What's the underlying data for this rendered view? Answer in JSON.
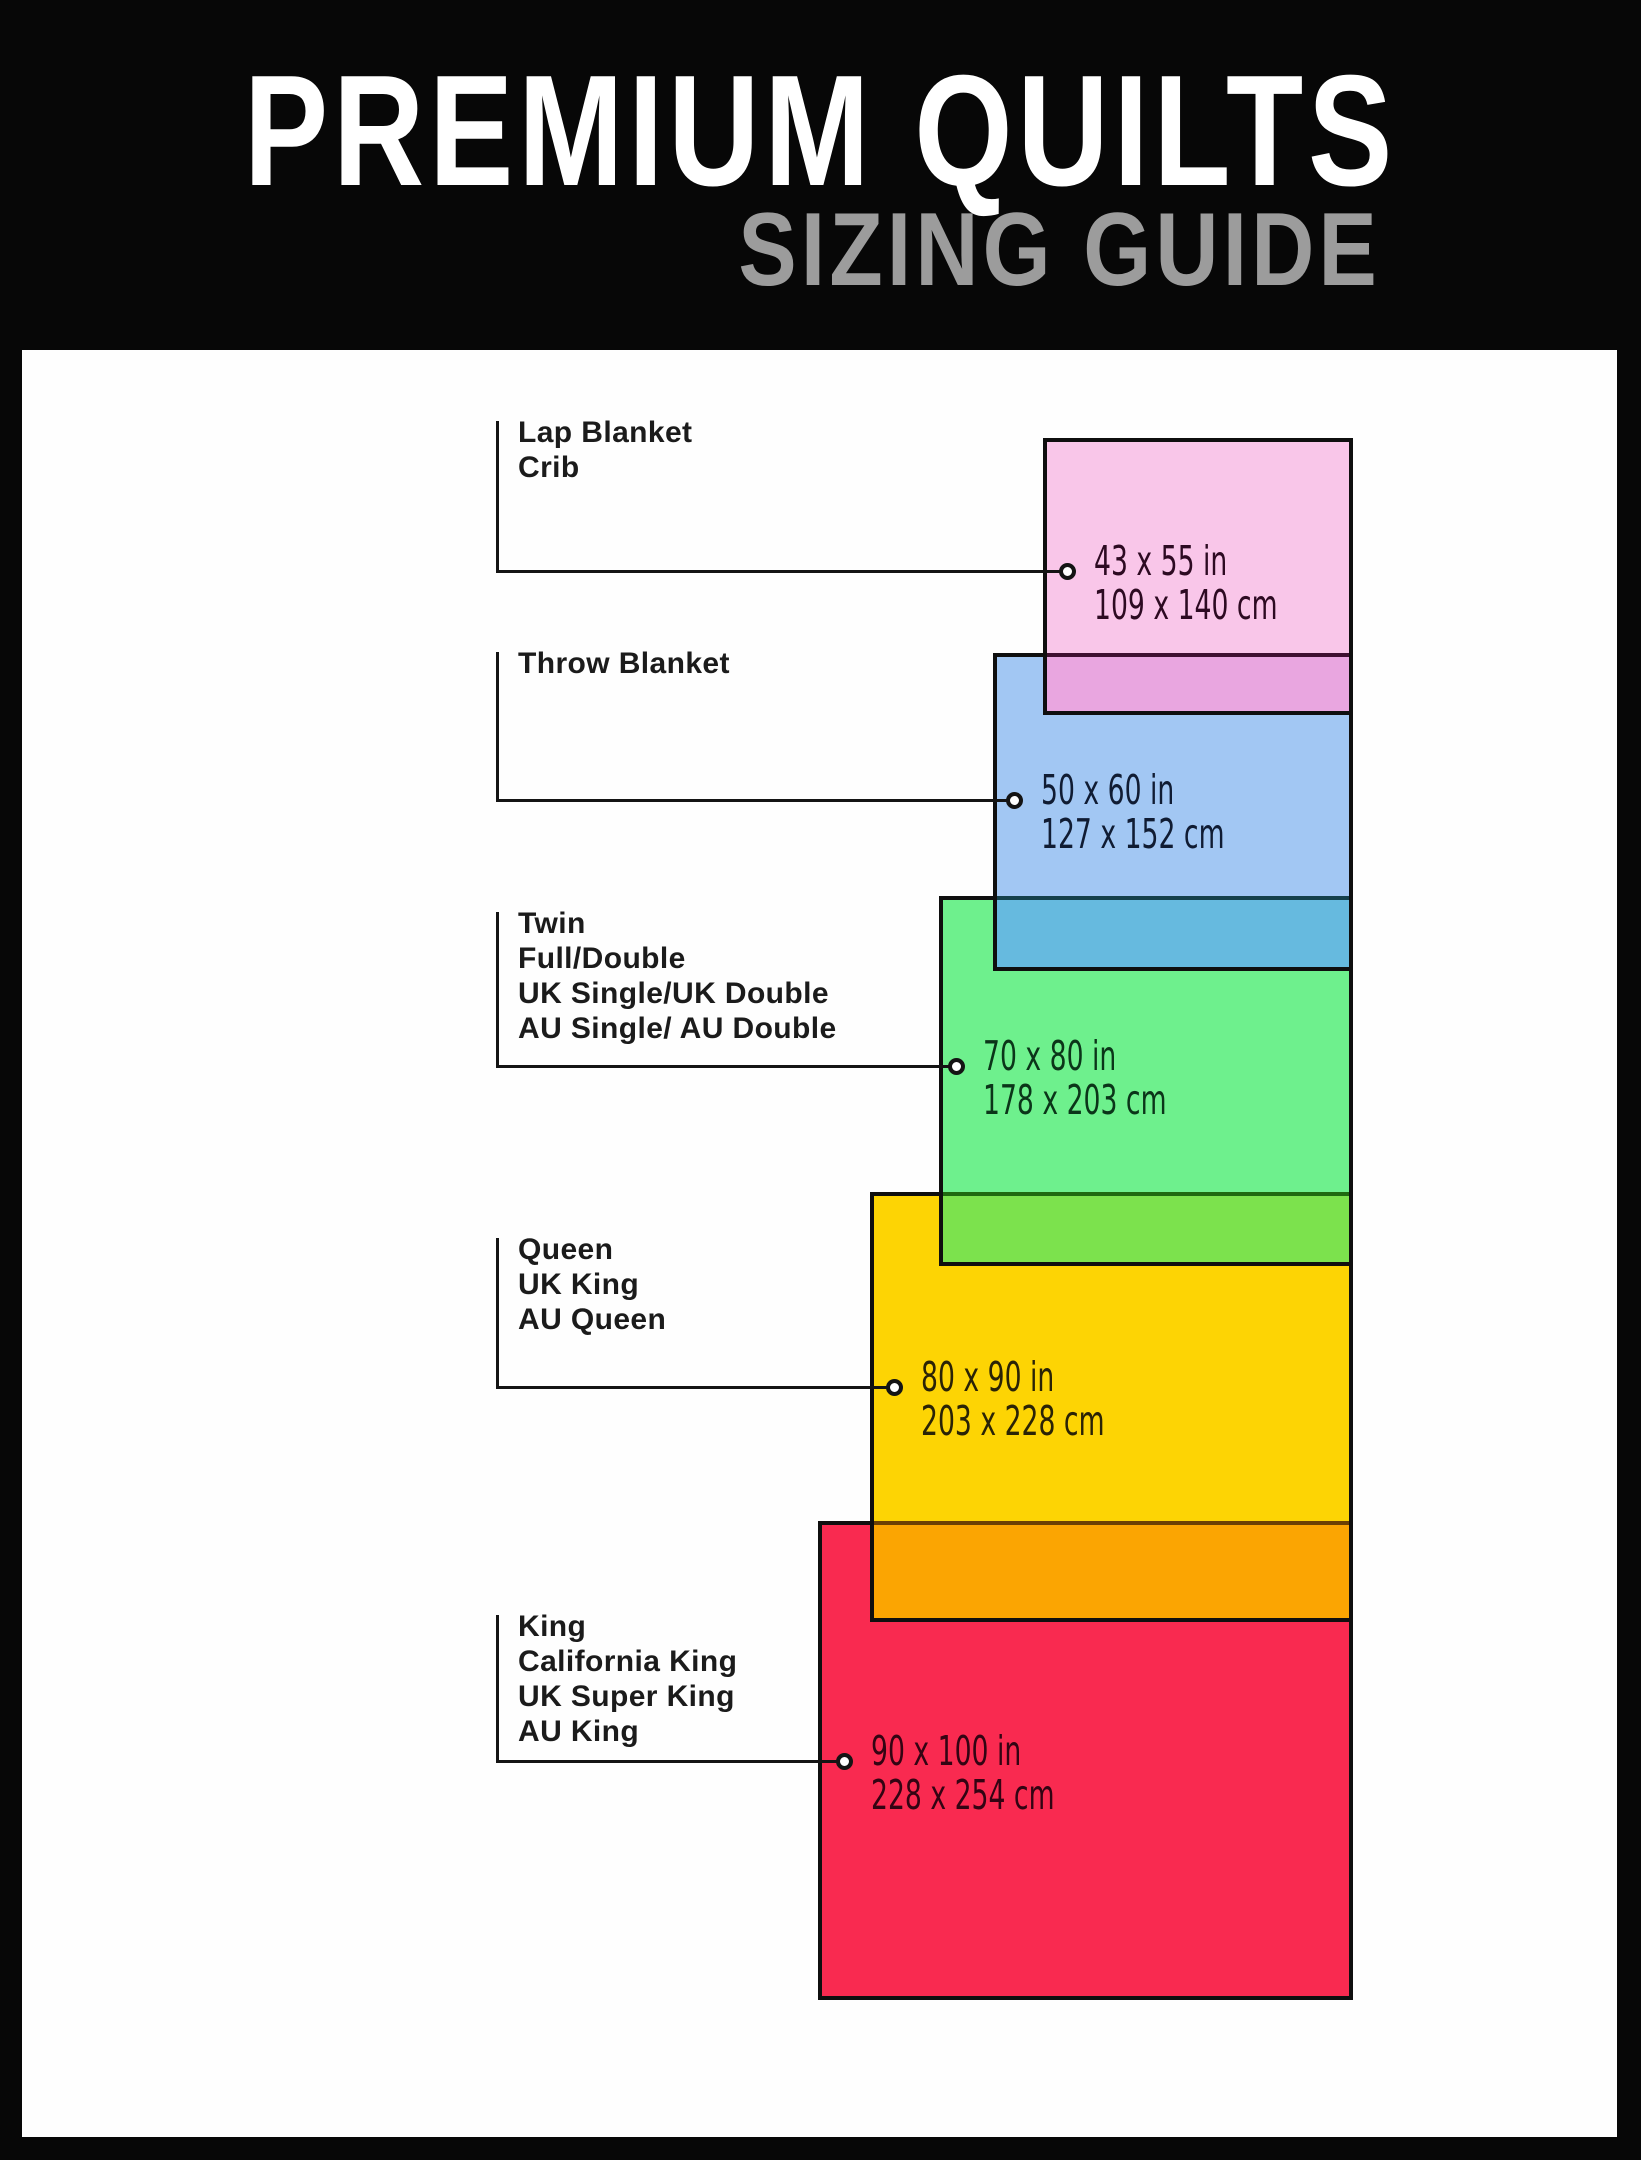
{
  "header": {
    "title": "PREMIUM QUILTS",
    "subtitle": "SIZING GUIDE",
    "title_color": "#ffffff",
    "subtitle_color": "#9c9c9c",
    "background_color": "#070707"
  },
  "canvas": {
    "background_color": "#fefefe",
    "line_color": "#141414"
  },
  "sizes": [
    {
      "labels": [
        "Lap Blanket",
        "Crib"
      ],
      "inches": "43 x 55 in",
      "cm": "109 x 140 cm",
      "colors": {
        "fill": "#f9c6e9",
        "overlap": "#e9a6e0",
        "overlap_border": "#3f1031",
        "text": "#2d0a22"
      }
    },
    {
      "labels": [
        "Throw Blanket"
      ],
      "inches": "50 x 60 in",
      "cm": "127 x 152 cm",
      "colors": {
        "fill": "#a2c7f3",
        "overlap": "#66badf",
        "overlap_border": "#15414b",
        "text": "#101c33"
      }
    },
    {
      "labels": [
        "Twin",
        "Full/Double",
        "UK Single/UK Double",
        "AU Single/ AU Double"
      ],
      "inches": "70 x 80 in",
      "cm": "178 x 203 cm",
      "colors": {
        "fill": "#6ef08d",
        "overlap": "#7ce24d",
        "overlap_border": "#1f6a10",
        "text": "#0b3519"
      }
    },
    {
      "labels": [
        "Queen",
        "UK King",
        "AU Queen"
      ],
      "inches": "80 x 90 in",
      "cm": "203 x 228 cm",
      "colors": {
        "fill": "#fdd404",
        "overlap": "#fba502",
        "overlap_border": "#6b4004",
        "text": "#2a2306"
      }
    },
    {
      "labels": [
        "King",
        "California King",
        "UK Super King",
        "AU King"
      ],
      "inches": "90 x 100 in",
      "cm": "228 x 254 cm",
      "colors": {
        "fill": "#f92a50",
        "text": "#330413"
      }
    }
  ]
}
